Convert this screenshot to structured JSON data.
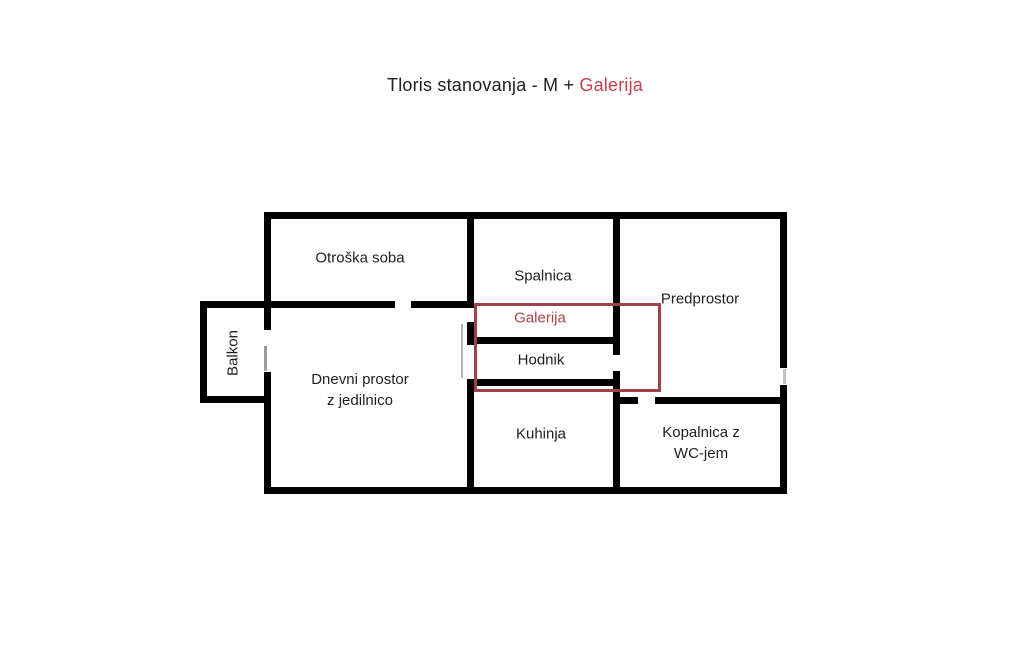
{
  "title": {
    "text_black": "Tloris stanovanja - M + ",
    "text_red": "Galerija"
  },
  "colors": {
    "background": "#ffffff",
    "wall": "#000000",
    "text": "#1f1f1f",
    "title_accent_red": "#c2414e",
    "galerija_outline_red": "#9e4249",
    "galerija_label_red": "#a8434a",
    "door_gray": "#9c9c9c"
  },
  "rooms": {
    "otroska_soba": {
      "label": "Otroška soba"
    },
    "spalnica": {
      "label": "Spalnica"
    },
    "predprostor": {
      "label": "Predprostor"
    },
    "galerija": {
      "label": "Galerija"
    },
    "hodnik": {
      "label": "Hodnik"
    },
    "balkon": {
      "label": "Balkon"
    },
    "dnevni_prostor": {
      "label_line1": "Dnevni prostor",
      "label_line2": "z jedilnico"
    },
    "kuhinja": {
      "label": "Kuhinja"
    },
    "kopalnica": {
      "label_line1": "Kopalnica z",
      "label_line2": "WC-jem"
    }
  }
}
